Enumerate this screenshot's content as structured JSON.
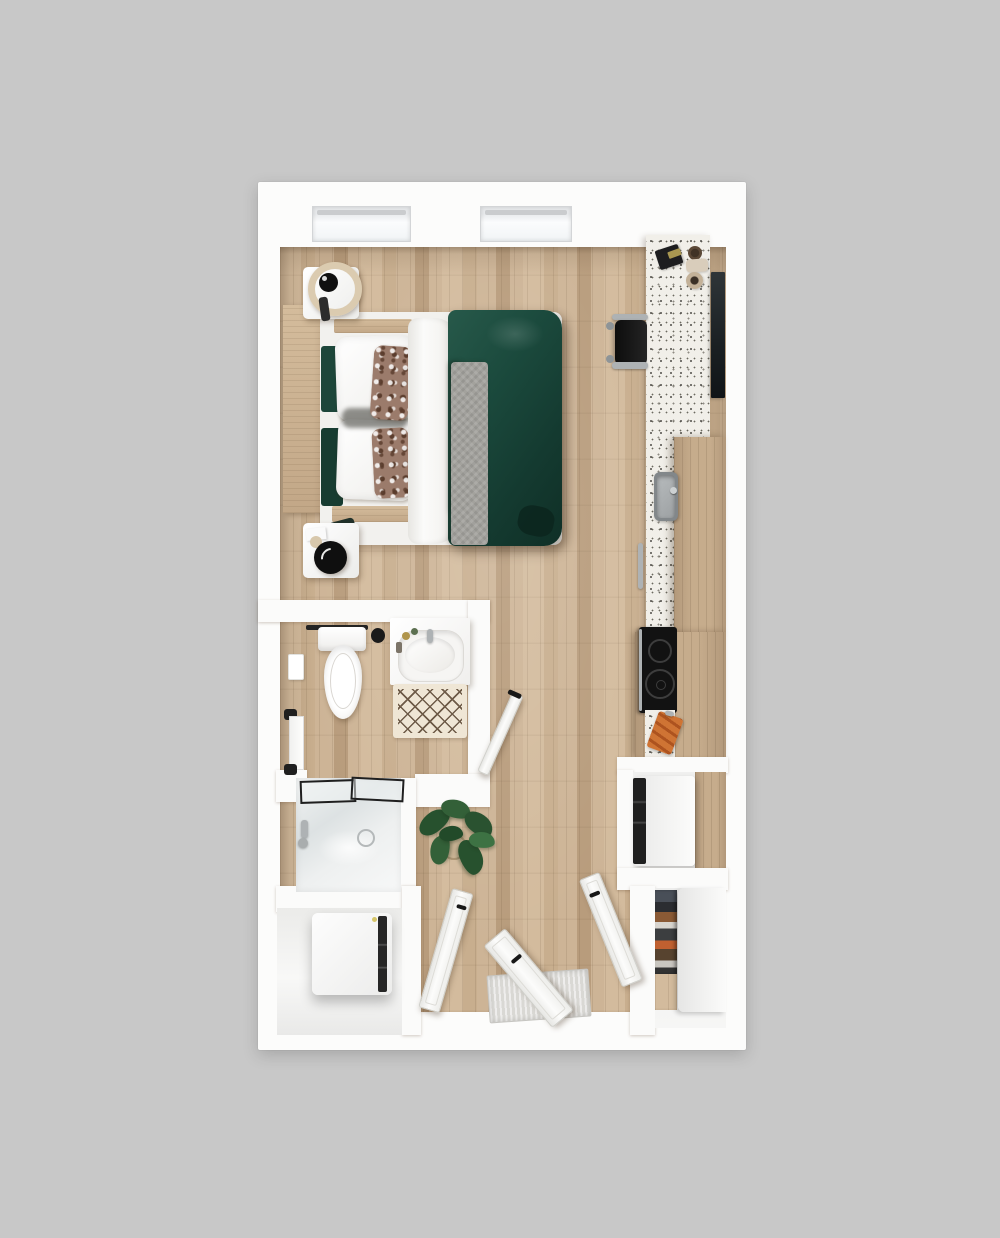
{
  "image_type": "3d-rendered studio apartment floor plan, top-down view",
  "visible_text": "none",
  "colors": {
    "bg": "#c8c8c8",
    "wall": "#fbfbfa",
    "wood-a": "#d3bb9d",
    "wood-b": "#c8ae8e",
    "wood-c": "#cdb496",
    "wood-d": "#b89c7c",
    "wood-cab-a": "#c6ac8c",
    "wood-cab-b": "#b2987a",
    "wood-furn-a": "#d4bc9c",
    "wood-furn-b": "#c2a787",
    "terrazzo": "#f1efe9",
    "duvet-light": "#27594a",
    "duvet": "#1b4a3d",
    "duvet-dark": "#0f2f26",
    "throw-gray": "#a3a29d",
    "tv-dark": "#1a1f22",
    "chair-black": "#161616",
    "chrome": "#aeb2b4",
    "mat-cream": "#efe6d5",
    "mat-line": "#6d5a47",
    "plant-dark": "#27512e",
    "plant-mid": "#336038",
    "plant-light": "#3d7243",
    "orange": "#c8692e",
    "shower-glass": "#e2e6e7"
  },
  "plan": {
    "windows": 2,
    "interior_doors": 4,
    "rooms": [
      {
        "name": "main-room",
        "furniture": [
          "double-bed-green-duvet",
          "wood-headboard",
          "nightstand-with-sphere-lamp-top",
          "nightstand-with-black-lamp-bottom",
          "desk-office-chair",
          "terrazzo-desk-counter",
          "wall-mounted-tv",
          "potted-plant"
        ]
      },
      {
        "name": "kitchen-run",
        "fixtures": [
          "terrazzo-countertop",
          "stainless-sink",
          "dishwasher-handle",
          "tall-wood-cabinet",
          "black-cooktop-two-burners",
          "orange-cutting-board",
          "oven-appliance-nook"
        ]
      },
      {
        "name": "bathroom",
        "fixtures": [
          "toilet",
          "towel-bar",
          "toilet-brush-jar",
          "vanity-with-oval-sink",
          "faucet",
          "diamond-pattern-bath-mat",
          "walk-in-shower-glass",
          "towel-rail",
          "toilet-paper-holder"
        ]
      },
      {
        "name": "laundry-nook",
        "fixtures": [
          "white-washer-dryer-unit"
        ]
      },
      {
        "name": "entry",
        "fixtures": [
          "entry-door-open",
          "gray-door-mat"
        ]
      },
      {
        "name": "closet",
        "fixtures": [
          "shoe-and-clothes-shelves",
          "white-sliding-panel"
        ]
      }
    ]
  }
}
